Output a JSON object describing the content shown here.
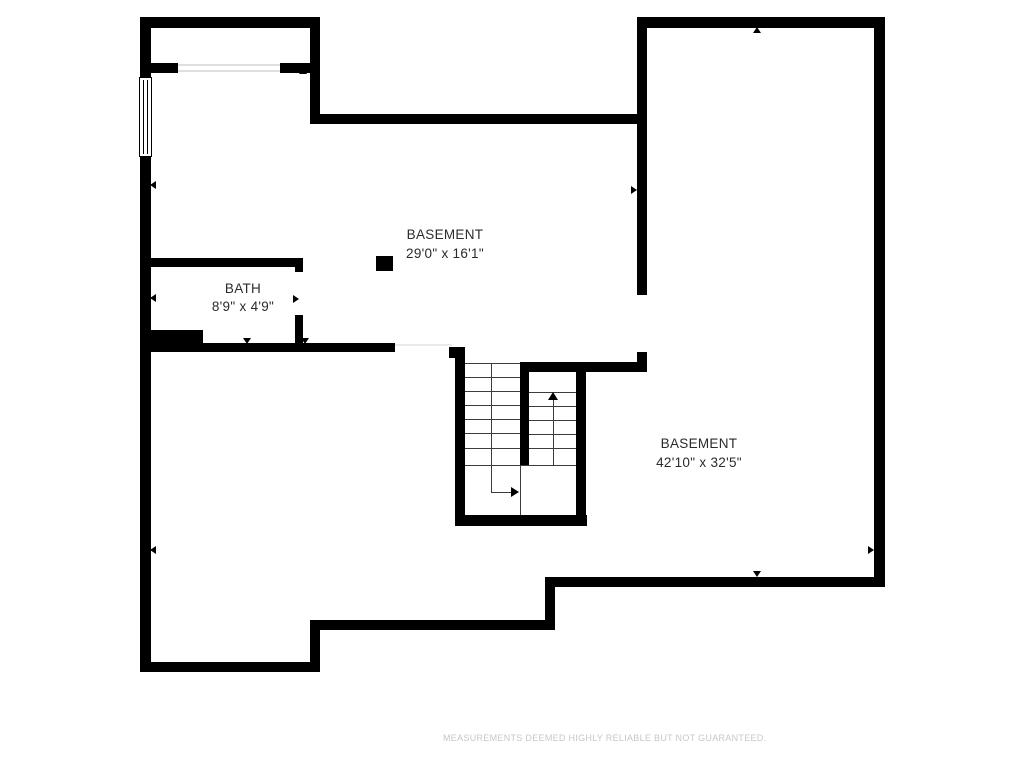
{
  "rooms": [
    {
      "name": "BASEMENT",
      "dimensions": "29'0\" x 16'1\""
    },
    {
      "name": "BATH",
      "dimensions": "8'9\" x 4'9\""
    },
    {
      "name": "BASEMENT",
      "dimensions": "42'10\" x 32'5\""
    }
  ],
  "disclaimer": "MEASUREMENTS DEEMED HIGHLY RELIABLE BUT NOT GUARANTEED.",
  "colors": {
    "wall": "#000000",
    "background": "#ffffff",
    "label": "#2b2b2b",
    "disclaimer": "#c7c7c7"
  }
}
